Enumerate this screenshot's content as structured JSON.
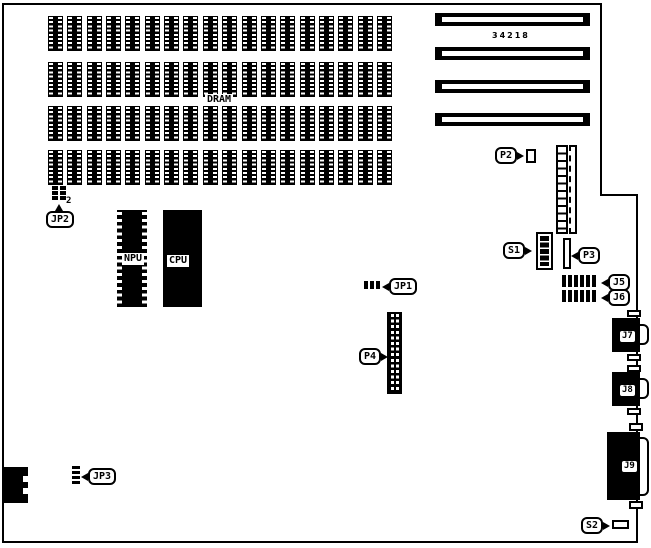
{
  "part_number": "34218",
  "dram": {
    "label": "DRAM",
    "rows": 4,
    "chips_per_row": 18
  },
  "processors": {
    "npu_label": "NPU",
    "cpu_label": "CPU"
  },
  "expansion_slots": {
    "count": 4
  },
  "callouts": {
    "jp1": "JP1",
    "jp2": "JP2",
    "jp2_pin": "2",
    "jp3": "JP3",
    "p2": "P2",
    "p3": "P3",
    "p4": "P4",
    "s1": "S1",
    "s2": "S2",
    "j5": "J5",
    "j6": "J6"
  },
  "port_labels": {
    "j7": "J7",
    "j8": "J8",
    "j9": "J9"
  }
}
